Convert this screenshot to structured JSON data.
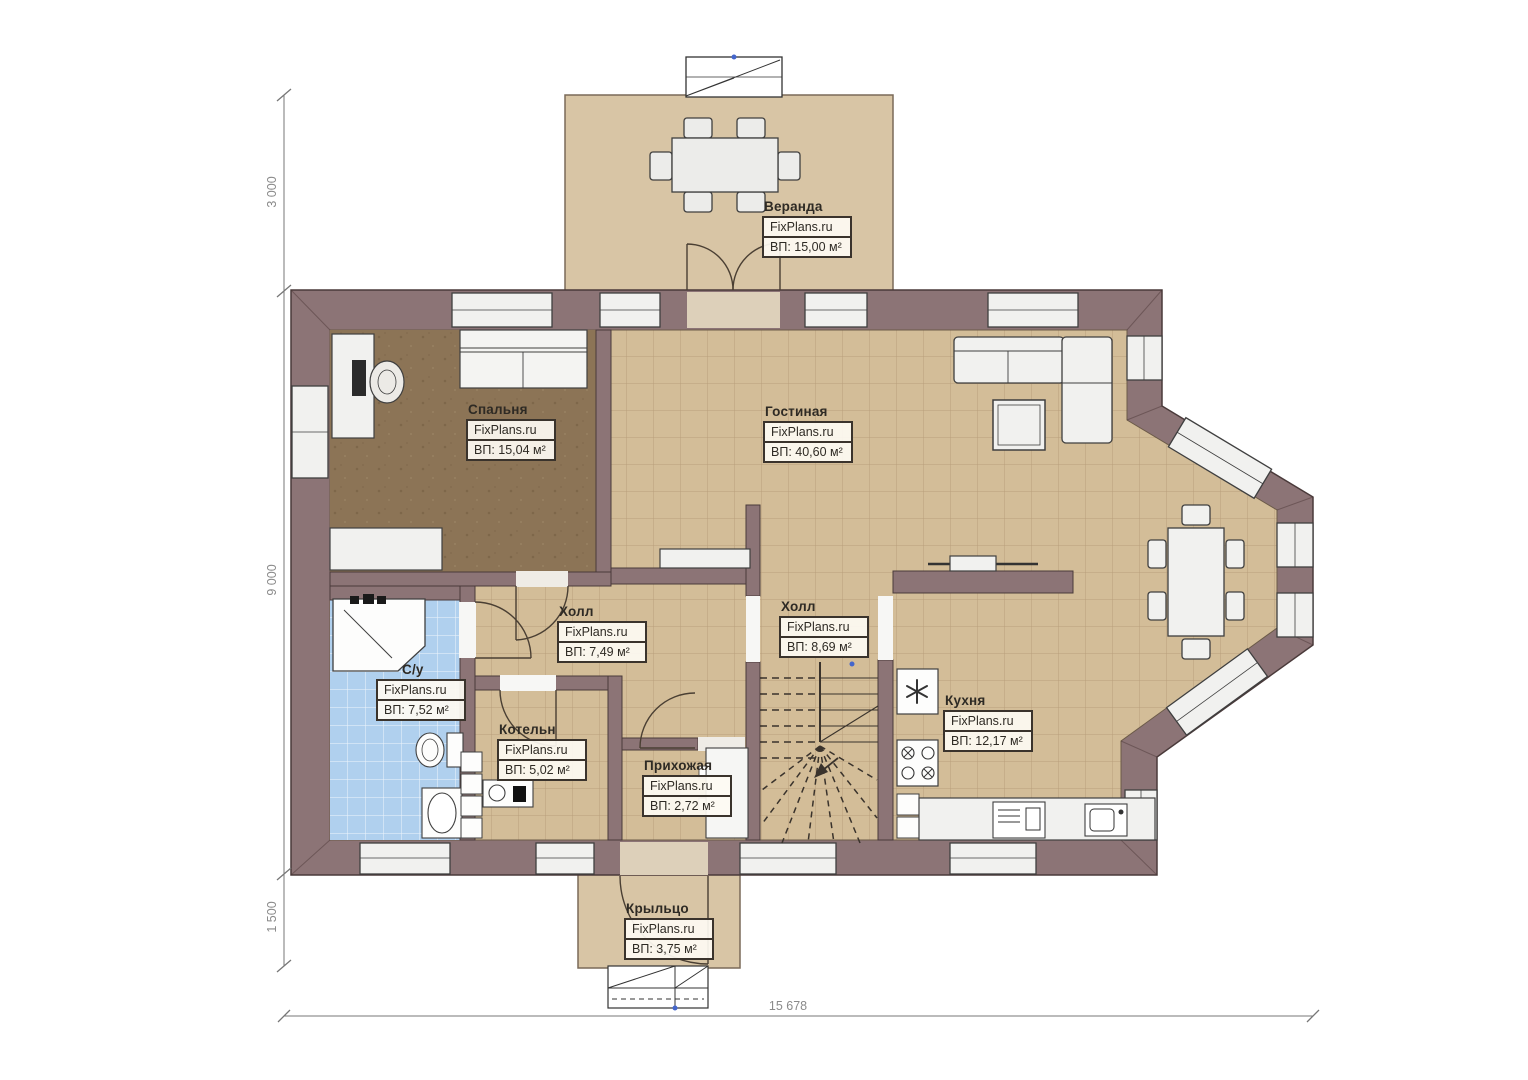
{
  "site_brand": "FixPlans.ru",
  "rooms": [
    {
      "id": "veranda",
      "name": "Веранда",
      "brand": "FixPlans.ru",
      "area": "ВП: 15,00 м²"
    },
    {
      "id": "bedroom",
      "name": "Спальня",
      "brand": "FixPlans.ru",
      "area": "ВП: 15,04 м²"
    },
    {
      "id": "living",
      "name": "Гостиная",
      "brand": "FixPlans.ru",
      "area": "ВП: 40,60 м²"
    },
    {
      "id": "hall-small",
      "name": "Холл",
      "brand": "FixPlans.ru",
      "area": "ВП: 7,49 м²"
    },
    {
      "id": "hall-stairs",
      "name": "Холл",
      "brand": "FixPlans.ru",
      "area": "ВП: 8,69 м²"
    },
    {
      "id": "bathroom",
      "name": "С/у",
      "brand": "FixPlans.ru",
      "area": "ВП: 7,52 м²"
    },
    {
      "id": "boiler",
      "name": "Котельн",
      "brand": "FixPlans.ru",
      "area": "ВП: 5,02 м²"
    },
    {
      "id": "entry",
      "name": "Прихожая",
      "brand": "FixPlans.ru",
      "area": "ВП: 2,72 м²"
    },
    {
      "id": "kitchen",
      "name": "Кухня",
      "brand": "FixPlans.ru",
      "area": "ВП: 12,17 м²"
    },
    {
      "id": "porch",
      "name": "Крыльцо",
      "brand": "FixPlans.ru",
      "area": "ВП: 3,75 м²"
    }
  ],
  "dimensions": {
    "left_top": "3 000",
    "left_middle": "9 000",
    "left_bottom": "1 500",
    "bottom_total": "15 678"
  },
  "colors": {
    "wall": "#8c7476",
    "tile_floor": "#d3bd98",
    "bedroom_floor": "#8c7456",
    "bathroom_floor": "#b0d0ee",
    "veranda_floor": "#d8c5a5",
    "furniture": "#f1f1ef",
    "label_border": "#3a332c",
    "dimension_text": "#8a8a8a",
    "marker_blue": "#4466cc"
  }
}
